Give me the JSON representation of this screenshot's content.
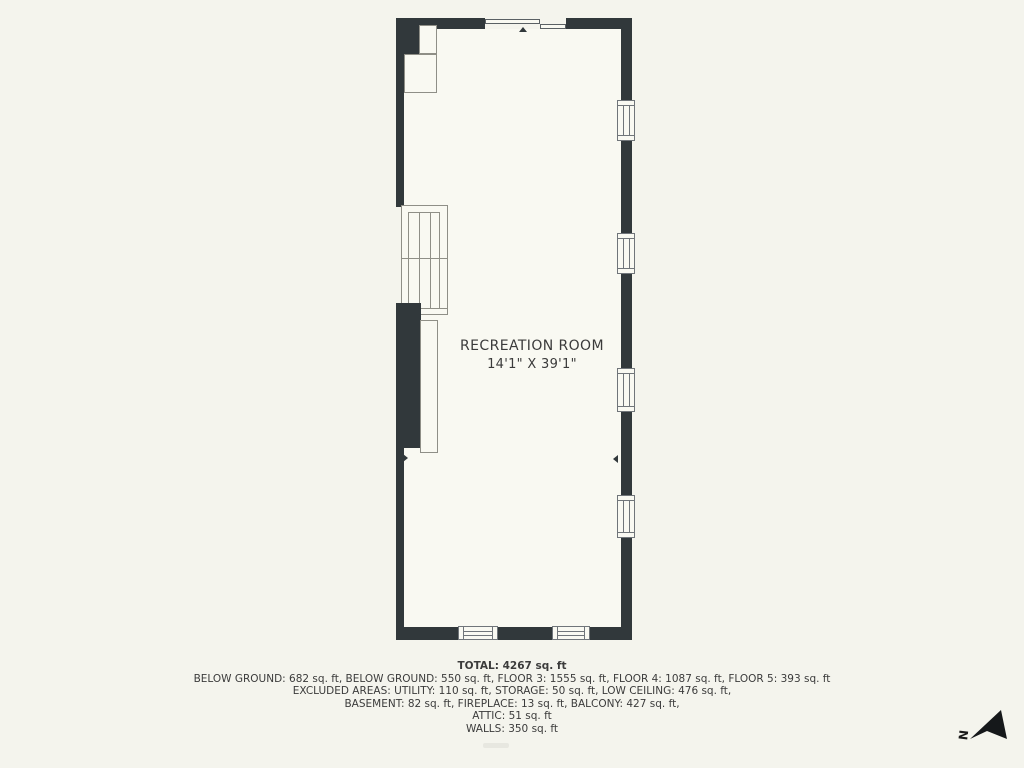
{
  "colors": {
    "background": "#f4f4ed",
    "wall": "#31383b",
    "floor": "#f9f9f2",
    "line": "#8f8f87",
    "text": "#3b3b3b"
  },
  "plan": {
    "room_name": "RECREATION ROOM",
    "room_dimensions": "14'1\" X 39'1\""
  },
  "summary": {
    "total": "TOTAL: 4267 sq. ft",
    "lines": [
      "BELOW GROUND: 682 sq. ft, BELOW GROUND: 550 sq. ft, FLOOR 3: 1555 sq. ft, FLOOR 4: 1087 sq. ft, FLOOR 5: 393 sq. ft",
      "EXCLUDED AREAS: UTILITY: 110 sq. ft, STORAGE: 50 sq. ft, LOW CEILING: 476 sq. ft,",
      "BASEMENT: 82 sq. ft, FIREPLACE: 13 sq. ft, BALCONY: 427 sq. ft,",
      "ATTIC: 51 sq. ft",
      "WALLS: 350 sq. ft"
    ]
  },
  "compass": {
    "label": "N"
  }
}
